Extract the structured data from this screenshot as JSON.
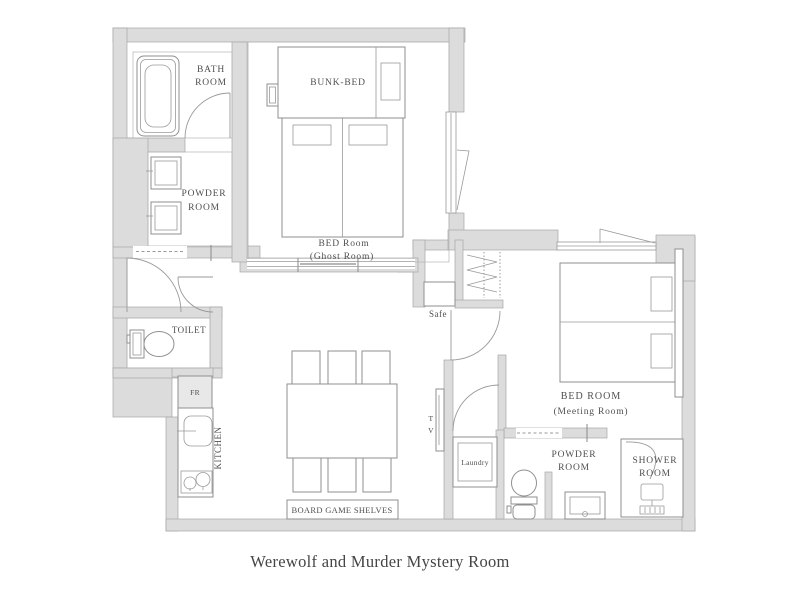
{
  "title": "Werewolf and Murder Mystery Room",
  "colors": {
    "wall_fill": "#dcdcdc",
    "wall_edge": "#a6a6a6",
    "furniture_line": "#8f8f8f",
    "text": "#4f4f4f",
    "background": "#ffffff"
  },
  "rooms": {
    "bath": {
      "l1": "BATH",
      "l2": "ROOM"
    },
    "powder1": {
      "l1": "POWDER",
      "l2": "ROOM"
    },
    "bunk": {
      "l1": "BUNK-BED"
    },
    "ghost": {
      "l1": "BED Room",
      "l2": "(Ghost Room)"
    },
    "toilet": {
      "l1": "TOILET"
    },
    "kitchen": {
      "l1": "KITCHEN",
      "fridge": "FR"
    },
    "living": {
      "shelves": "BOARD GAME SHELVES",
      "tv_t": "T",
      "tv_v": "V"
    },
    "hall": {
      "safe": "Safe",
      "laundry": "Laundry"
    },
    "meeting": {
      "l1": "BED ROOM",
      "l2": "(Meeting Room)"
    },
    "powder2": {
      "l1": "POWDER",
      "l2": "ROOM"
    },
    "shower": {
      "l1": "SHOWER",
      "l2": "ROOM"
    }
  }
}
